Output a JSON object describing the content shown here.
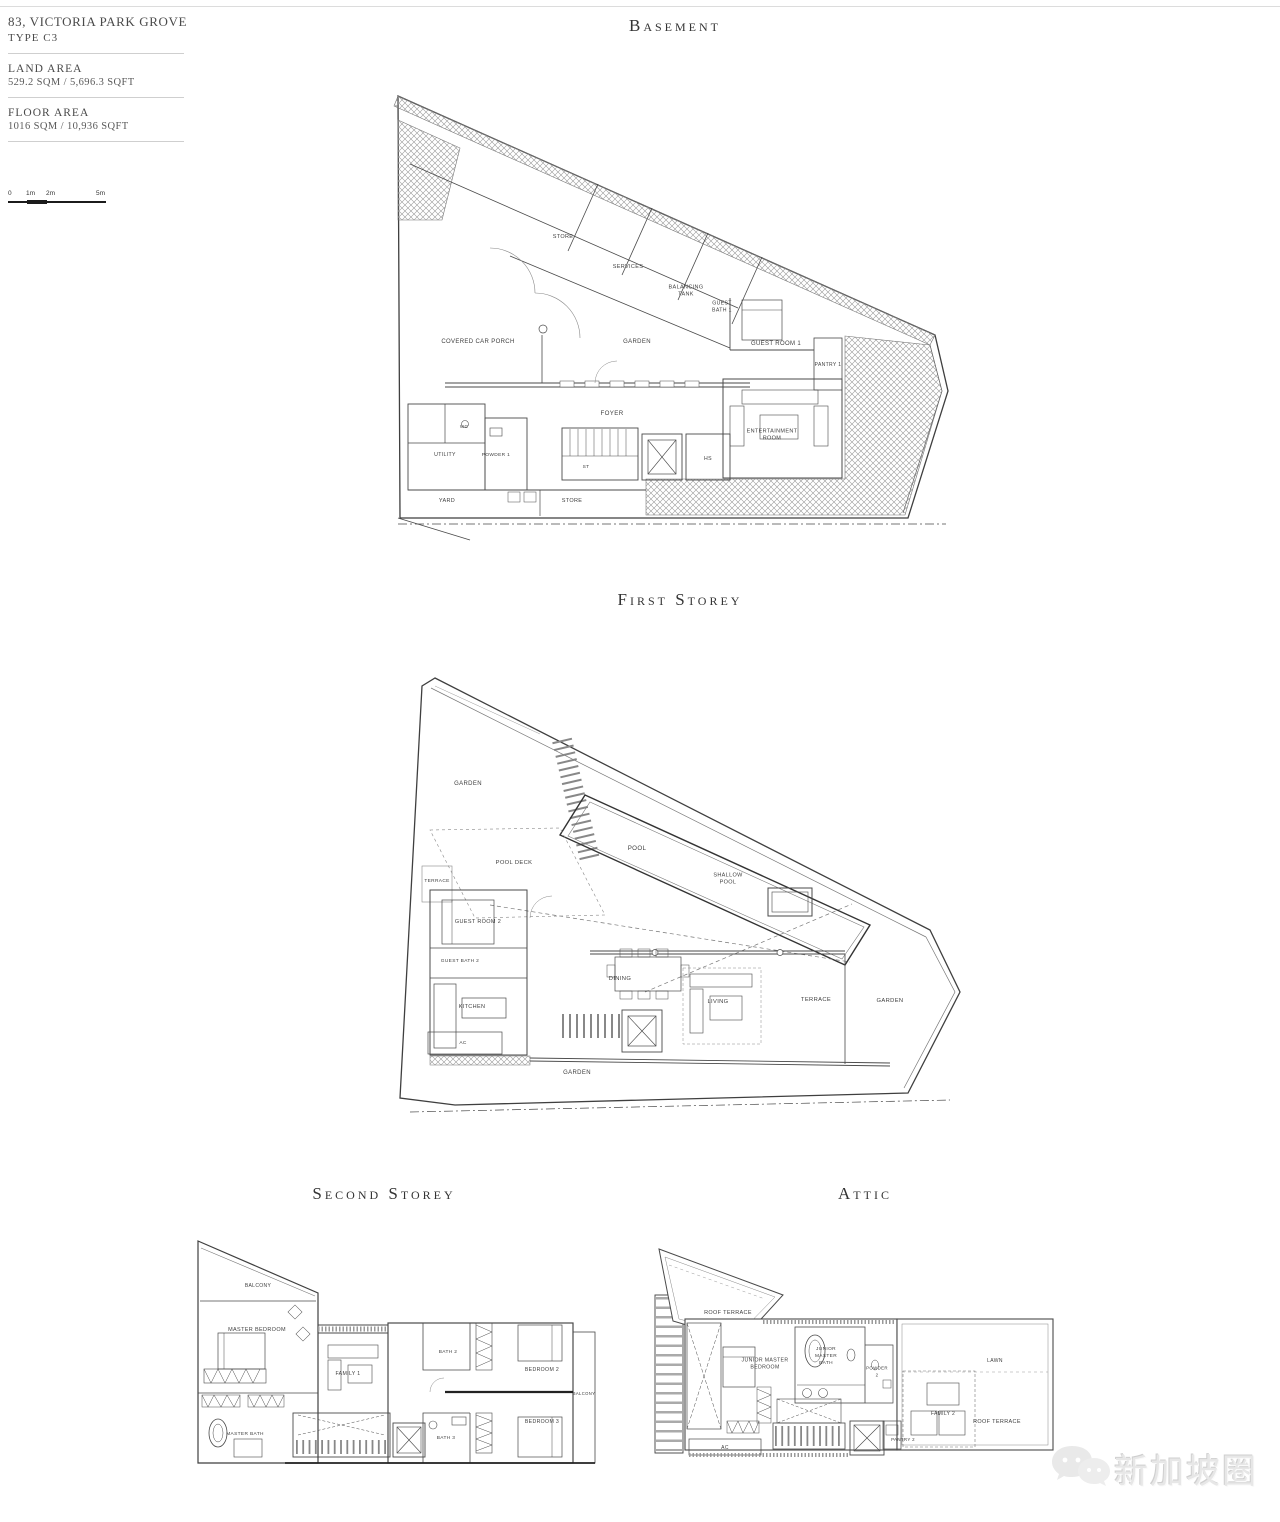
{
  "info_panel": {
    "title": "83, VICTORIA PARK GROVE",
    "type": "TYPE C3",
    "land_area_label": "LAND AREA",
    "land_area_value": "529.2 SQM / 5,696.3 SQFT",
    "floor_area_label": "FLOOR AREA",
    "floor_area_value": "1016 SQM / 10,936 SQFT",
    "scale_bar": {
      "ticks": [
        "0",
        "1m",
        "2m",
        "5m"
      ]
    }
  },
  "plans": {
    "basement": {
      "title": "Basement",
      "labels": [
        {
          "t": "STORE",
          "x": 173,
          "y": 150,
          "fs": 5.5
        },
        {
          "t": "SERVICES",
          "x": 238,
          "y": 180,
          "fs": 5.5
        },
        {
          "t": "BALANCING\nTANK",
          "x": 296,
          "y": 204,
          "fs": 5.5
        },
        {
          "t": "GUEST\nBATH 1",
          "x": 332,
          "y": 220,
          "fs": 5.2
        },
        {
          "t": "GARDEN",
          "x": 247,
          "y": 255,
          "fs": 6
        },
        {
          "t": "GUEST ROOM 1",
          "x": 386,
          "y": 257,
          "fs": 6
        },
        {
          "t": "PANTRY 1",
          "x": 438,
          "y": 278,
          "fs": 5
        },
        {
          "t": "FOYER",
          "x": 222,
          "y": 327,
          "fs": 6.2
        },
        {
          "t": "ENTERTAINMENT\nROOM",
          "x": 382,
          "y": 348,
          "fs": 5.5
        },
        {
          "t": "COVERED CAR PORCH",
          "x": 88,
          "y": 255,
          "fs": 6
        },
        {
          "t": "UTILITY",
          "x": 55,
          "y": 368,
          "fs": 5.2
        },
        {
          "t": "WC",
          "x": 74,
          "y": 340,
          "fs": 4.6
        },
        {
          "t": "POWDER 1",
          "x": 106,
          "y": 368,
          "fs": 4.8
        },
        {
          "t": "ST",
          "x": 196,
          "y": 380,
          "fs": 4.8
        },
        {
          "t": "HS",
          "x": 318,
          "y": 372,
          "fs": 5.2
        },
        {
          "t": "YARD",
          "x": 57,
          "y": 414,
          "fs": 5.5
        },
        {
          "t": "STORE",
          "x": 182,
          "y": 414,
          "fs": 5.5
        }
      ]
    },
    "first_storey": {
      "title": "First Storey",
      "labels": [
        {
          "t": "GARDEN",
          "x": 78,
          "y": 125,
          "fs": 6
        },
        {
          "t": "POOL DECK",
          "x": 124,
          "y": 204,
          "fs": 5.8
        },
        {
          "t": "POOL",
          "x": 247,
          "y": 190,
          "fs": 6.2
        },
        {
          "t": "SHALLOW\nPOOL",
          "x": 338,
          "y": 220,
          "fs": 5.5
        },
        {
          "t": "TERRACE",
          "x": 47,
          "y": 222,
          "fs": 4.8
        },
        {
          "t": "GUEST ROOM 2",
          "x": 88,
          "y": 263,
          "fs": 5.5
        },
        {
          "t": "GUEST BATH 2",
          "x": 70,
          "y": 302,
          "fs": 4.8
        },
        {
          "t": "KITCHEN",
          "x": 82,
          "y": 348,
          "fs": 5.5
        },
        {
          "t": "AC",
          "x": 73,
          "y": 384,
          "fs": 4.8
        },
        {
          "t": "DINING",
          "x": 230,
          "y": 320,
          "fs": 5.8
        },
        {
          "t": "LIVING",
          "x": 328,
          "y": 343,
          "fs": 5.8
        },
        {
          "t": "TERRACE",
          "x": 426,
          "y": 341,
          "fs": 5.8
        },
        {
          "t": "GARDEN",
          "x": 500,
          "y": 342,
          "fs": 5.8
        },
        {
          "t": "GARDEN",
          "x": 187,
          "y": 414,
          "fs": 6
        }
      ]
    },
    "second_storey": {
      "title": "Second Storey",
      "labels": [
        {
          "t": "BALCONY",
          "x": 68,
          "y": 52,
          "fs": 5
        },
        {
          "t": "MASTER BEDROOM",
          "x": 67,
          "y": 96,
          "fs": 5.5
        },
        {
          "t": "FAMILY 1",
          "x": 158,
          "y": 140,
          "fs": 5.2
        },
        {
          "t": "BATH 2",
          "x": 258,
          "y": 118,
          "fs": 4.8
        },
        {
          "t": "BEDROOM 2",
          "x": 352,
          "y": 136,
          "fs": 5.2
        },
        {
          "t": "BALCONY",
          "x": 394,
          "y": 160,
          "fs": 4.2
        },
        {
          "t": "MASTER BATH",
          "x": 55,
          "y": 200,
          "fs": 4.8
        },
        {
          "t": "BATH 3",
          "x": 256,
          "y": 204,
          "fs": 4.8
        },
        {
          "t": "BEDROOM 3",
          "x": 352,
          "y": 188,
          "fs": 5.2
        }
      ]
    },
    "attic": {
      "title": "Attic",
      "labels": [
        {
          "t": "ROOF TERRACE",
          "x": 83,
          "y": 79,
          "fs": 5.5
        },
        {
          "t": "JUNIOR MASTER\nBEDROOM",
          "x": 120,
          "y": 130,
          "fs": 5.2
        },
        {
          "t": "JUNIOR\nMASTER\nBATH",
          "x": 181,
          "y": 122,
          "fs": 4.8
        },
        {
          "t": "POWDER\n2",
          "x": 232,
          "y": 138,
          "fs": 4.4
        },
        {
          "t": "FAMILY 2",
          "x": 298,
          "y": 180,
          "fs": 5
        },
        {
          "t": "PANTRY 2",
          "x": 258,
          "y": 206,
          "fs": 4.4
        },
        {
          "t": "ROOF TERRACE",
          "x": 352,
          "y": 188,
          "fs": 5.5
        },
        {
          "t": "LAWN",
          "x": 350,
          "y": 127,
          "fs": 5
        },
        {
          "t": "AC",
          "x": 80,
          "y": 214,
          "fs": 5
        }
      ]
    }
  },
  "watermark": {
    "text": "新加坡圈"
  }
}
